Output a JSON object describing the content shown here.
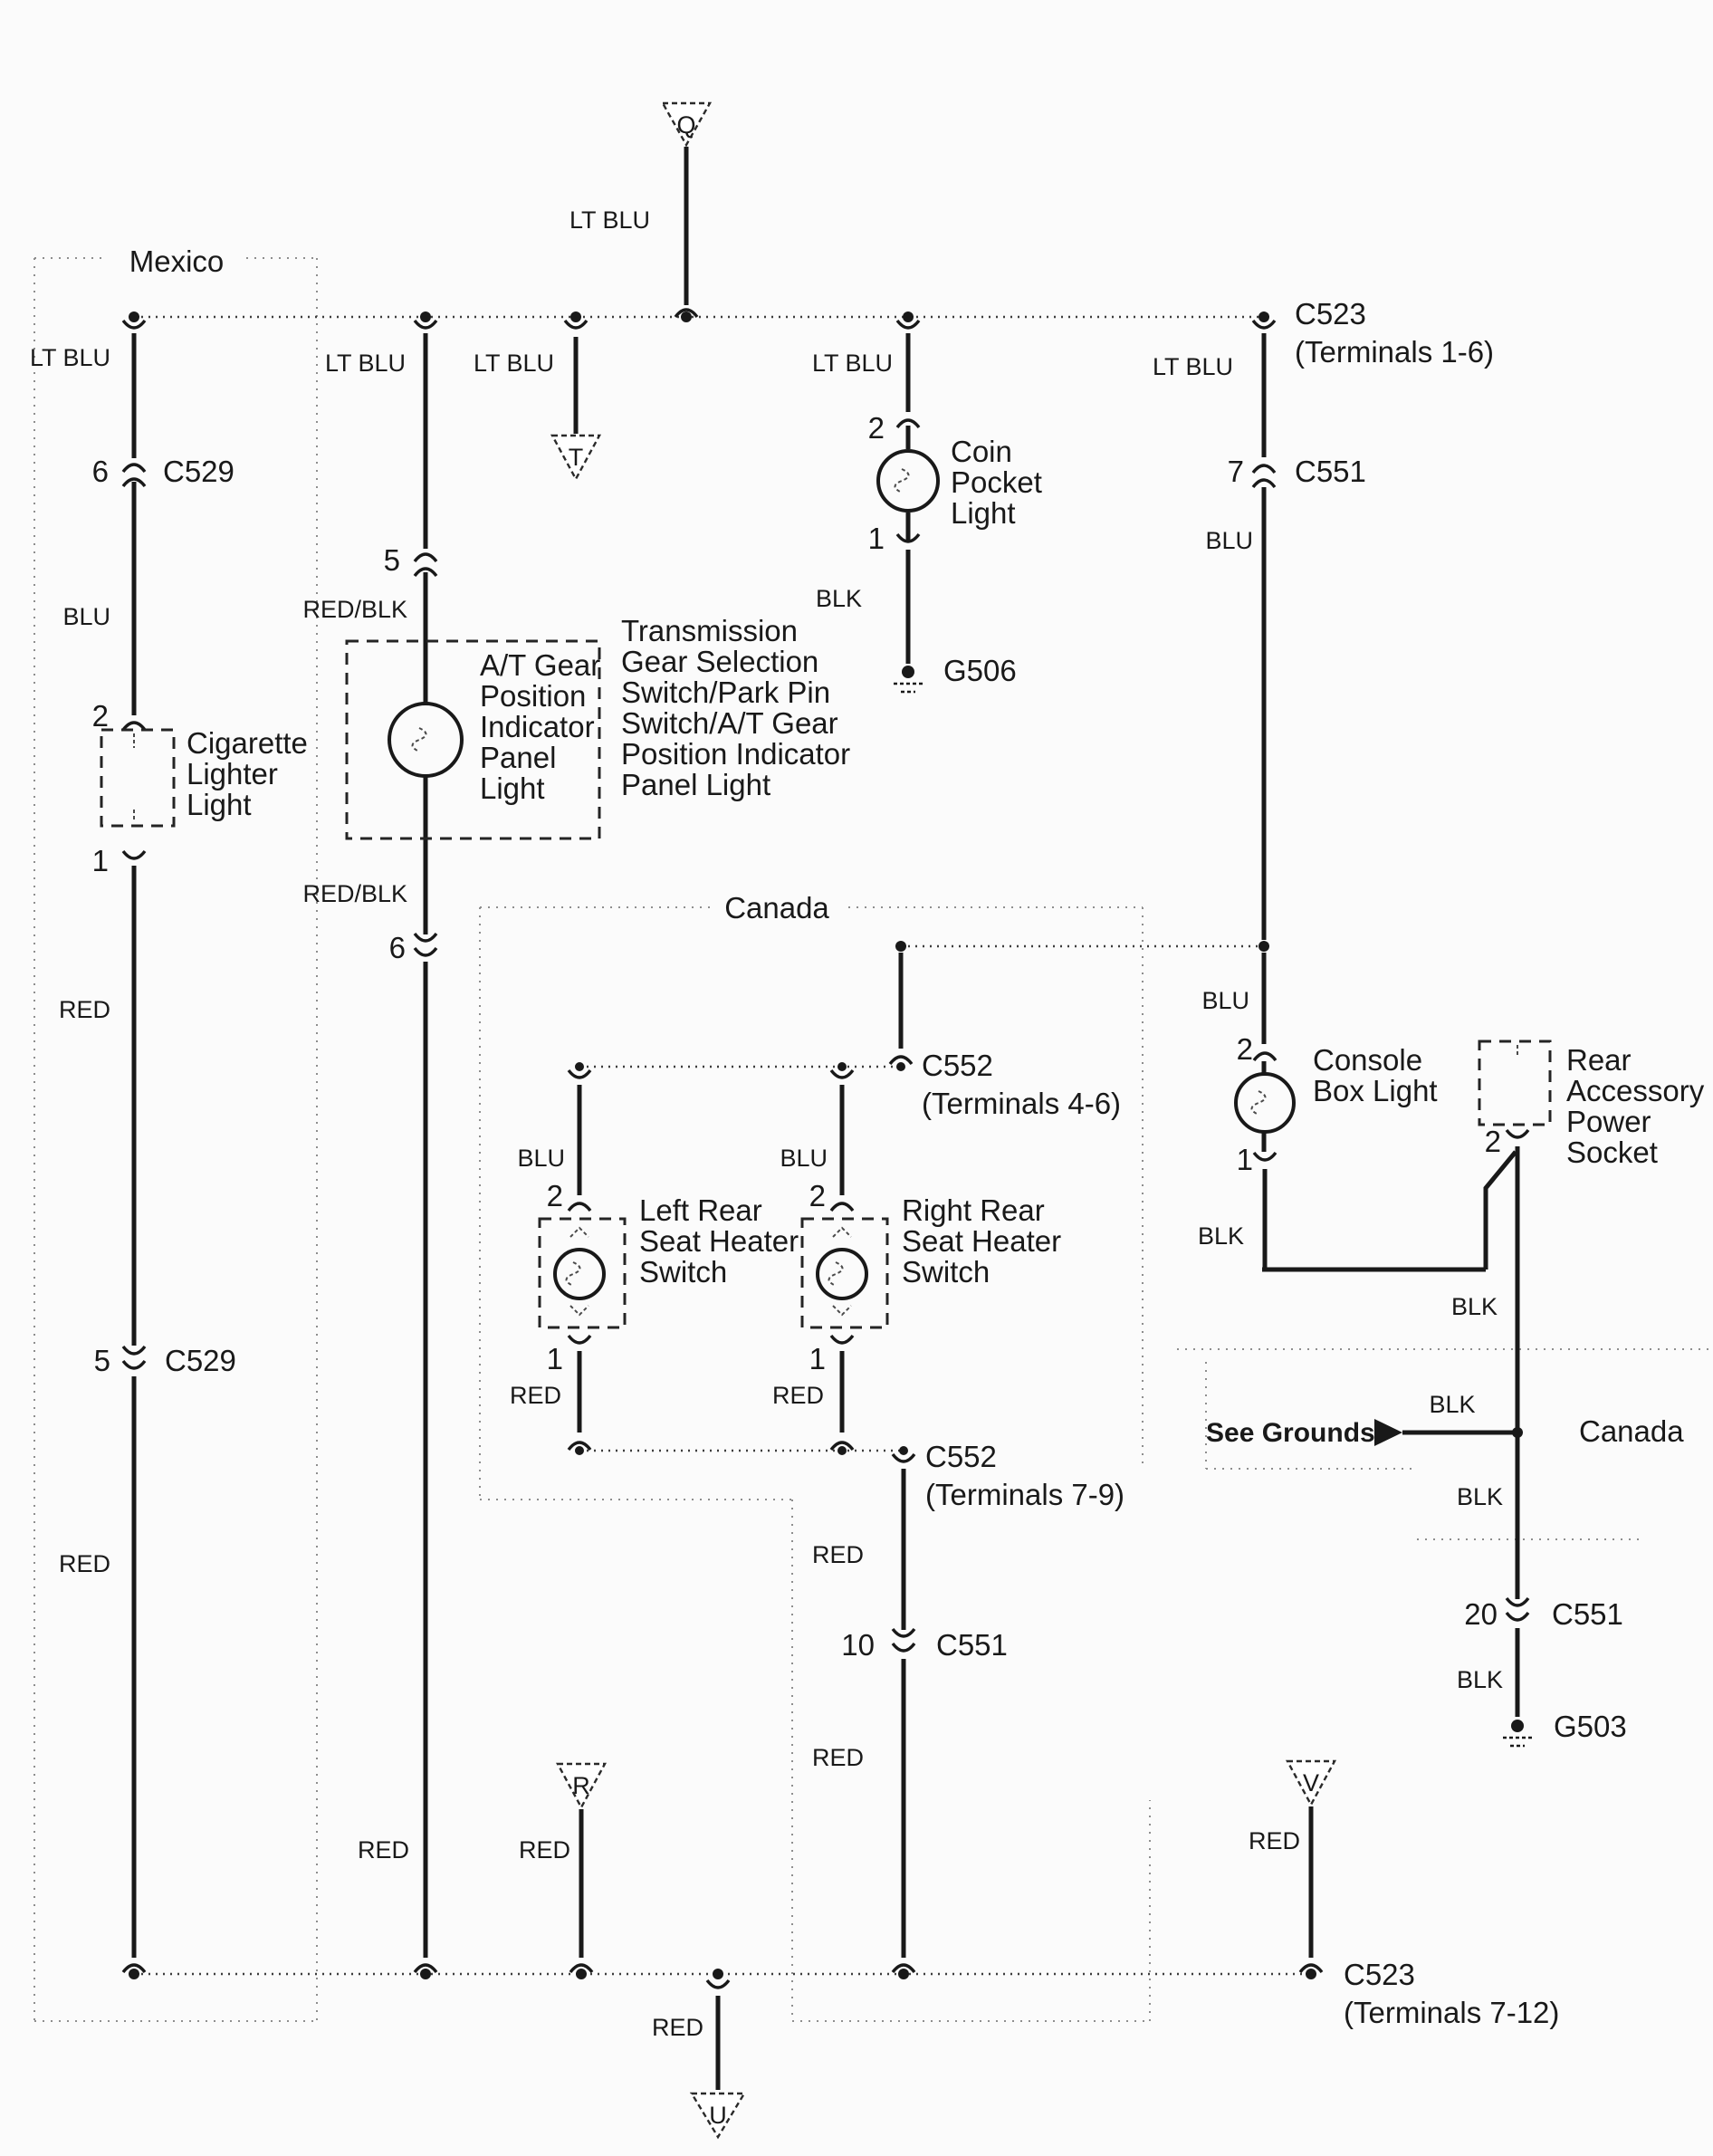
{
  "diagram": {
    "type": "automotive-wiring-diagram",
    "subject": "console / interior lights circuit",
    "colors": {
      "ink": "#191919",
      "region_border": "#8e8e8e",
      "paper": "#fbfbfb"
    }
  },
  "labels": {
    "mexico": "Mexico",
    "canada_mid": "Canada",
    "canada_right": "Canada",
    "see_grounds": "See Grounds",
    "tri_q": "Q",
    "tri_t": "T",
    "tri_r": "R",
    "tri_u": "U",
    "tri_v": "V"
  },
  "wires": {
    "q_ltblu": "LT BLU",
    "col1_ltblu": "LT BLU",
    "col1_blu": "BLU",
    "col1_red1": "RED",
    "col1_red2": "RED",
    "col2_ltblu": "LT BLU",
    "col2_redblk1": "RED/BLK",
    "col2_redblk2": "RED/BLK",
    "col2_red": "RED",
    "t_ltblu": "LT BLU",
    "coin_ltblu": "LT BLU",
    "coin_blk": "BLK",
    "right_ltblu": "LT BLU",
    "right_blu1": "BLU",
    "right_blu2": "BLU",
    "right_blk": "BLK",
    "socket_blk": "BLK",
    "sg_blk_left": "BLK",
    "sg_blk_below": "BLK",
    "g503_blk": "BLK",
    "heater_left_blu": "BLU",
    "heater_left_red": "RED",
    "heater_right_blu": "BLU",
    "heater_right_red": "RED",
    "mid_red1": "RED",
    "mid_red2": "RED",
    "r_red": "RED",
    "u_red": "RED",
    "v_red": "RED"
  },
  "pins": {
    "col1_6": "6",
    "col1_2": "2",
    "col1_1": "1",
    "col1_5": "5",
    "col2_5": "5",
    "col2_6": "6",
    "coin_2": "2",
    "coin_1": "1",
    "right_7": "7",
    "right_2": "2",
    "right_1": "1",
    "socket_2": "2",
    "hl_2": "2",
    "hl_1": "1",
    "hr_2": "2",
    "hr_1": "1",
    "mid_10": "10",
    "right_20": "20"
  },
  "connectors": {
    "c529_top": "C529",
    "c529_bot": "C529",
    "c523_top": "C523",
    "c523_top_terms": "(Terminals 1-6)",
    "c551_top": "C551",
    "c551_mid": "C551",
    "c551_bot": "C551",
    "c552_46": "C552",
    "c552_46_terms": "(Terminals 4-6)",
    "c552_79": "C552",
    "c552_79_terms": "(Terminals 7-9)",
    "c523_bot": "C523",
    "c523_bot_terms": "(Terminals 7-12)"
  },
  "grounds": {
    "g506": "G506",
    "g503": "G503"
  },
  "components": {
    "cigarette": [
      "Cigarette",
      "Lighter",
      "Light"
    ],
    "at_gear": [
      "A/T Gear",
      "Position",
      "Indicator",
      "Panel",
      "Light"
    ],
    "transmission_note": [
      "Transmission",
      "Gear Selection",
      "Switch/Park Pin",
      "Switch/A/T Gear",
      "Position Indicator",
      "Panel Light"
    ],
    "coin_pocket": [
      "Coin",
      "Pocket",
      "Light"
    ],
    "console_box": [
      "Console",
      "Box Light"
    ],
    "rear_socket": [
      "Rear",
      "Accessory",
      "Power",
      "Socket"
    ],
    "left_heater": [
      "Left Rear",
      "Seat Heater",
      "Switch"
    ],
    "right_heater": [
      "Right Rear",
      "Seat Heater",
      "Switch"
    ]
  }
}
